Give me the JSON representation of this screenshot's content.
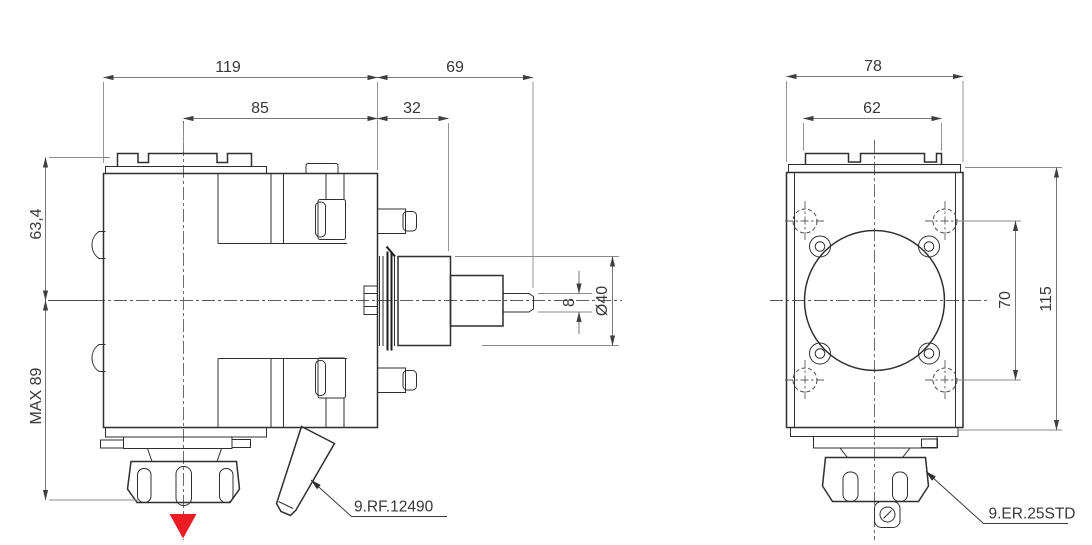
{
  "drawing": {
    "colors": {
      "arrow_red": "#ec1c24",
      "line": "#2f2f31",
      "dim": "#767676"
    },
    "front": {
      "dim_width_total": "119",
      "dim_width_right": "69",
      "dim_width_center_to_face": "85",
      "dim_width_face_to_step": "32",
      "dim_height_upper": "63,4",
      "dim_height_lower": "MAX 89",
      "dim_shaft_width": "8",
      "dim_spindle_diameter": "Ø40",
      "leader_label": "9.RF.12490"
    },
    "side": {
      "dim_width_total": "78",
      "dim_plate_width": "62",
      "dim_hole_spacing": "70",
      "dim_height_total": "115",
      "leader_label": "9.ER.25STD"
    }
  }
}
